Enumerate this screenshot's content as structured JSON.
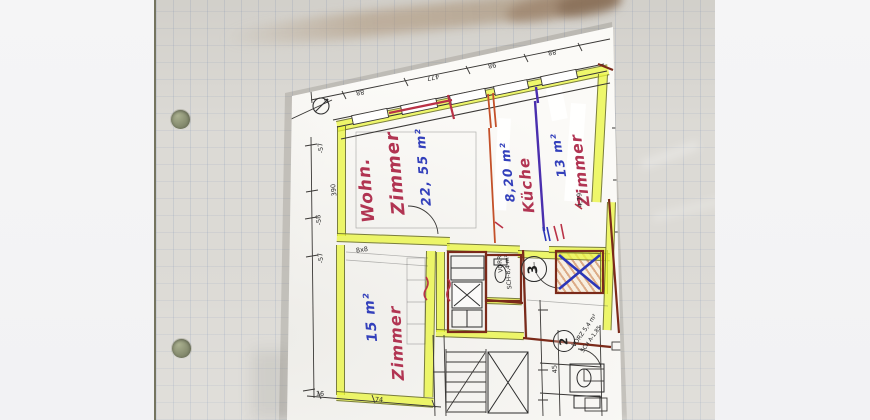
{
  "rooms": [
    {
      "id": "wohnzimmer",
      "label_line1": "Wohn.",
      "label_line2": "Zimmer",
      "area": "22, 55 m²"
    },
    {
      "id": "kueche",
      "label": "Küche",
      "area": "8,20 m²"
    },
    {
      "id": "zimmer13",
      "label": "Zimmer",
      "area": "13 m²"
    },
    {
      "id": "zimmer15",
      "label": "Zimmer",
      "area": "15 m²"
    }
  ],
  "annotations": {
    "circled": [
      "3",
      "2"
    ],
    "notes": [
      "VORR",
      "SCH-8,4 m²",
      "VORZ 5,4 m²",
      "SCH A-1,85"
    ]
  },
  "dimensions": {
    "top_outer": [
      "140",
      "477",
      "88",
      "110",
      "170"
    ],
    "top_inner": [
      "88",
      "477",
      "98",
      "88"
    ],
    "left": [
      "-57",
      "390",
      "-58",
      "-57"
    ],
    "misc": [
      "8x8",
      "74",
      "16",
      "4,79",
      "45"
    ]
  },
  "colors": {
    "highlighter": "#e9f63c",
    "red_pen": "#b13452",
    "blue_pen": "#3340bb",
    "purple_pen": "#4a2fae",
    "maroon_ink": "#7b2a1a",
    "grid_paper": "#dcdad5",
    "plan_paper": "#fbfaf7"
  }
}
